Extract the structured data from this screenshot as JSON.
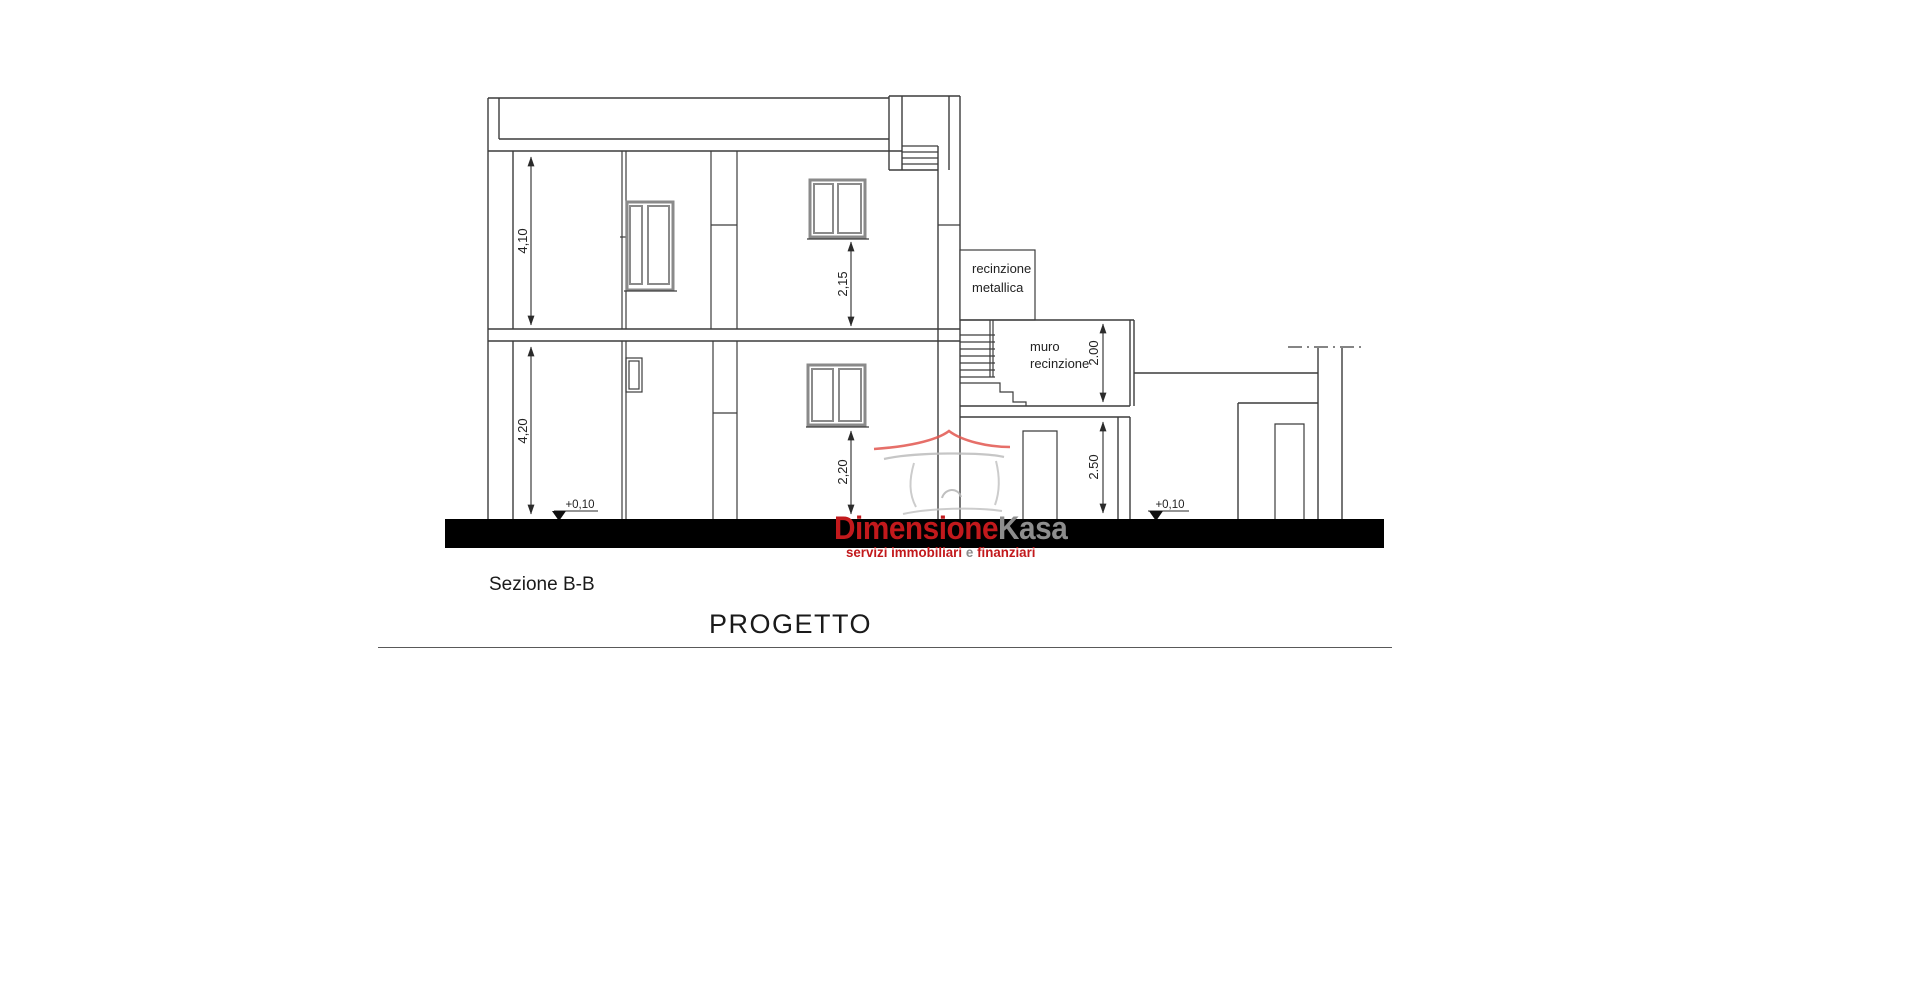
{
  "drawing": {
    "caption": "Sezione B-B",
    "title": "PROGETTO",
    "dimensions": {
      "upper_floor_height": "4,10",
      "ground_floor_height": "4,20",
      "upper_window_height": "2,15",
      "ground_window_height": "2,20",
      "fence_wall_height": "2.00",
      "annex_height": "2.50"
    },
    "levels": {
      "left": "+0,10",
      "right": "+0,10"
    },
    "labels": {
      "metal_fence_line1": "recinzione",
      "metal_fence_line2": "metallica",
      "fence_wall_line1": "muro",
      "fence_wall_line2": "recinzione"
    },
    "colors": {
      "line": "#3c3c3c",
      "window_frame": "#8a8a8a",
      "ground_fill": "#000000"
    }
  },
  "watermark": {
    "brand_primary": "Dimensione",
    "brand_secondary": "Kasa",
    "tagline_primary": "servizi immobiliari",
    "tagline_conjunction": "e",
    "tagline_secondary": "finanziari",
    "colors": {
      "brand_red": "#c2191c",
      "brand_gray": "#8d8d8d",
      "logo_red": "#e2574f",
      "logo_gray": "#c4c4c4"
    }
  }
}
